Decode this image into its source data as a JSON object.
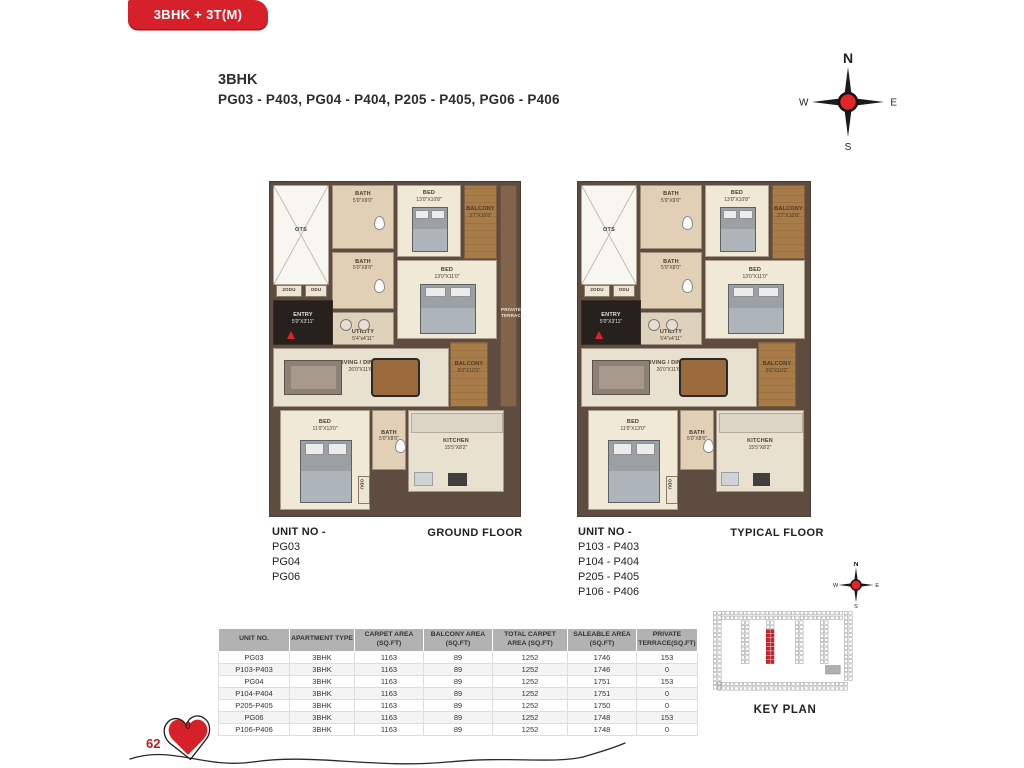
{
  "header": {
    "badge": "3BHK + 3T(M)",
    "title": "3BHK",
    "subtitle": "PG03 - P403, PG04 - P404, P205 - P405, PG06 - P406"
  },
  "compass": {
    "n": "N",
    "e": "E",
    "s": "S",
    "w": "W"
  },
  "floorplan": {
    "rooms": [
      {
        "key": "ots",
        "label": "OTS",
        "dims": ""
      },
      {
        "key": "bath1",
        "label": "BATH",
        "dims": "5'0\"X9'0\""
      },
      {
        "key": "bed1",
        "label": "BED",
        "dims": "13'0\"X10'8\""
      },
      {
        "key": "balcony1",
        "label": "BALCONY",
        "dims": "3'7\"X10'8\""
      },
      {
        "key": "bath2",
        "label": "BATH",
        "dims": "5'0\"X8'0\""
      },
      {
        "key": "bed2",
        "label": "BED",
        "dims": "13'0\"X11'0\""
      },
      {
        "key": "terrace",
        "label": "PRIVATE TERRACE",
        "dims": ""
      },
      {
        "key": "utility",
        "label": "UTILITY",
        "dims": "5'4\"x4'11\""
      },
      {
        "key": "entry",
        "label": "ENTRY",
        "dims": "5'0\"X3'11\""
      },
      {
        "key": "odu1",
        "label": "2ODU",
        "dims": ""
      },
      {
        "key": "odu2",
        "label": "ODU",
        "dims": ""
      },
      {
        "key": "living",
        "label": "LIVING / DINING",
        "dims": "26'0\"X11'6\""
      },
      {
        "key": "balcony2",
        "label": "BALCONY",
        "dims": "5'0\"X10'2\""
      },
      {
        "key": "bed3",
        "label": "BED",
        "dims": "11'0\"X13'0\""
      },
      {
        "key": "bath3",
        "label": "BATH",
        "dims": "5'0\"X8'6\""
      },
      {
        "key": "odu3",
        "label": "ODU",
        "dims": ""
      },
      {
        "key": "kitchen",
        "label": "KITCHEN",
        "dims": "15'5\"X8'2\""
      }
    ]
  },
  "plans": [
    {
      "caption": "GROUND FLOOR",
      "unit_heading": "UNIT NO -",
      "units": [
        "PG03",
        "PG04",
        "PG06"
      ],
      "has_terrace": true
    },
    {
      "caption": "TYPICAL FLOOR",
      "unit_heading": "UNIT NO -",
      "units": [
        "P103 - P403",
        "P104 - P404",
        "P205 - P405",
        "P106 - P406"
      ],
      "has_terrace": false
    }
  ],
  "table": {
    "headers": [
      "UNIT NO.",
      "APARTMENT TYPE",
      "CARPET AREA (SQ.FT)",
      "BALCONY AREA (SQ.FT)",
      "TOTAL CARPET AREA (SQ.FT)",
      "SALEABLE AREA (SQ.FT)",
      "PRIVATE TERRACE(SQ.FT)"
    ],
    "rows": [
      [
        "PG03",
        "3BHK",
        "1163",
        "89",
        "1252",
        "1746",
        "153"
      ],
      [
        "P103-P403",
        "3BHK",
        "1163",
        "89",
        "1252",
        "1746",
        "0"
      ],
      [
        "PG04",
        "3BHK",
        "1163",
        "89",
        "1252",
        "1751",
        "153"
      ],
      [
        "P104-P404",
        "3BHK",
        "1163",
        "89",
        "1252",
        "1751",
        "0"
      ],
      [
        "P205-P405",
        "3BHK",
        "1163",
        "89",
        "1252",
        "1750",
        "0"
      ],
      [
        "PG06",
        "3BHK",
        "1163",
        "89",
        "1252",
        "1748",
        "153"
      ],
      [
        "P106-P406",
        "3BHK",
        "1163",
        "89",
        "1252",
        "1748",
        "0"
      ]
    ]
  },
  "keyplan": {
    "label": "KEY PLAN"
  },
  "footer": {
    "page_number": "62"
  },
  "colors": {
    "accent_red": "#d6212a",
    "table_header_bg": "#b2b2b2",
    "wall_brown": "#5e4c41",
    "balcony_brown": "#a87c48"
  }
}
